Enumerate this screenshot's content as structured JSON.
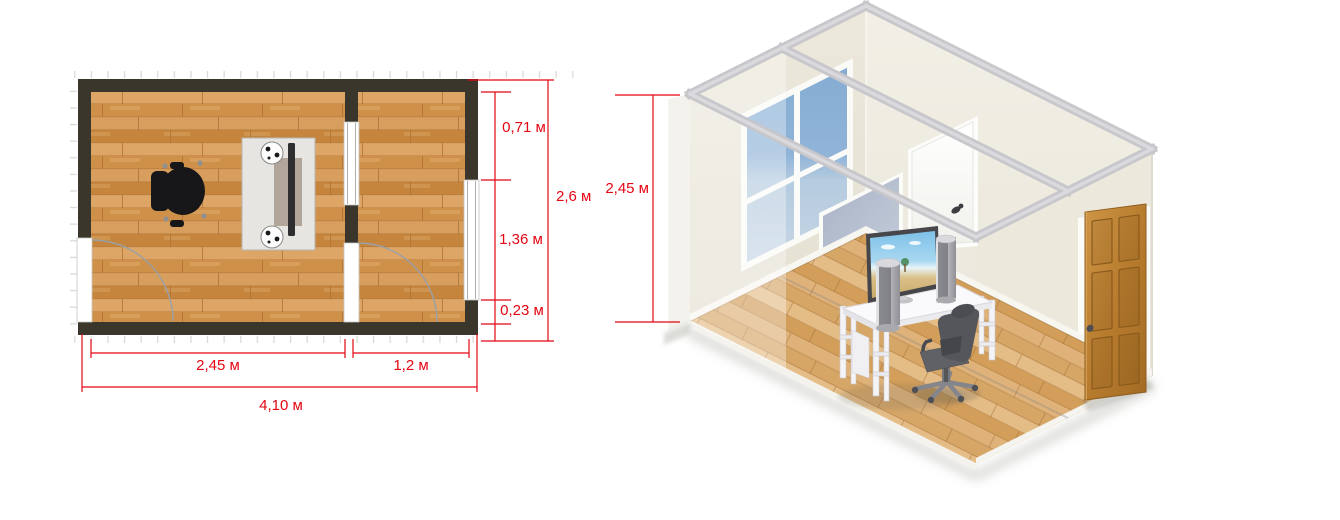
{
  "scene": {
    "type": "room-planner-screenshot",
    "background": "#ffffff",
    "accent_red": "#e30613"
  },
  "floor_plan": {
    "wall_color": "#3a362c",
    "floor_wood_color": "#cf9049",
    "objects": {
      "desk": "tv-stand-with-tv-and-speakers",
      "chair": "office-chair",
      "doors": "left-wall-door, partition-door",
      "windows": "right-wall-window, partition-window"
    },
    "dims": {
      "seg_top": "0,71 м",
      "seg_mid": "1,36 м",
      "seg_bottom": "0,23 м",
      "side_total": "2,6 м",
      "bottom_left": "2,45 м",
      "bottom_right": "1,2 м",
      "bottom_total": "4,10 м"
    }
  },
  "room_3d": {
    "wall_color": "#e9e5d8",
    "floor_wood_color": "#d9a96a",
    "window_glass_color": "#8fb3d8",
    "wood_door_color": "#b87c2e",
    "dims": {
      "wall_height": "2,45 м"
    }
  }
}
